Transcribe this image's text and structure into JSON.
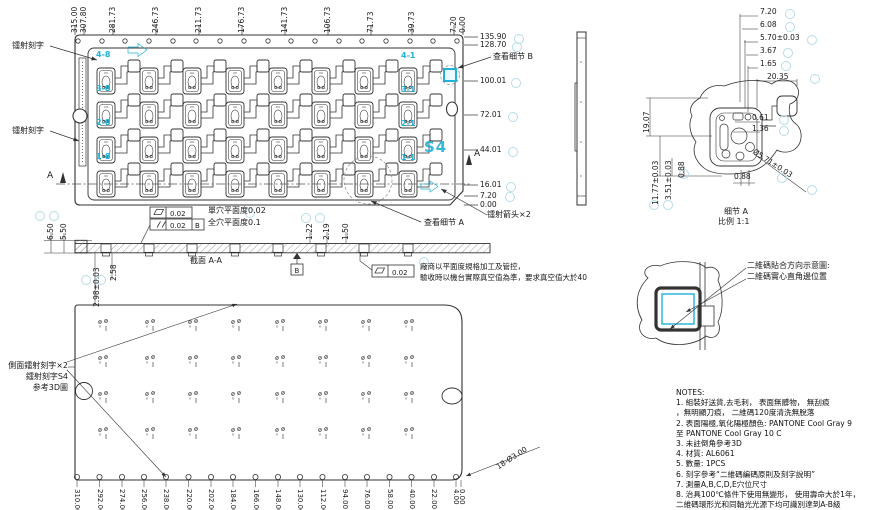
{
  "colors": {
    "cyan": "#1fb1d8",
    "line": "#333333",
    "balloon": "#b7dce8"
  },
  "top_view": {
    "laser_label_1": "镭射刻字",
    "laser_label_2": "镭射刻字",
    "top_dims": [
      "315.00",
      "307.80",
      "281.73",
      "246.73",
      "211.73",
      "176.73",
      "141.73",
      "106.73",
      "71.73",
      "39.73",
      "7.20",
      "0.00"
    ],
    "right_dims": [
      "135.90",
      "128.70",
      "100.01",
      "72.01",
      "44.01",
      "16.01",
      "7.20",
      "0.00"
    ],
    "row_labels_left": [
      "4-8",
      "3-8",
      "2-8",
      "1-8"
    ],
    "row_labels_right": [
      "4-1",
      "3-1",
      "2-1",
      "1-1"
    ],
    "marker_s4": "S4",
    "detail_b_note": "查看细节 B",
    "detail_a_note": "查看细节 A",
    "laser_arrow_note": "镭射箭头×2",
    "section_letter": "A"
  },
  "section": {
    "title": "截面 A-A",
    "dim_650": "6.50",
    "dim_550": "5.50",
    "dim_122": "1.22",
    "dim_219": "2.19",
    "dim_150": "1.50",
    "dim_298": "2.98±0.03",
    "dim_258": "2.58",
    "fcf_flat_val": "0.02",
    "fcf_par_val": "0.02",
    "fcf_par_datum": "B",
    "note_single": "單穴平面度0.02",
    "note_all": "全穴平面度0.1",
    "datum_b": "B",
    "fcf_right_val": "0.02",
    "vendor_note_1": "廠商以平面度規格加工及管控，",
    "vendor_note_2": "驗收時以機台實際真空值為準，要求真空值大於40"
  },
  "detail_a": {
    "dim_720": "7.20",
    "dim_608": "6.08",
    "dim_570": "5.70±0.03",
    "dim_367": "3.67",
    "dim_165": "1.65",
    "dim_2035": "20.35",
    "dim_1907": "19.07",
    "dim_1177": "11.77±0.03",
    "dim_351": "3.51±0.03",
    "dim_088_left": "0.88",
    "dim_061": "0.61",
    "dim_136": "1.36",
    "dim_dia": "Ø5.71±0.03",
    "dim_088_bottom": "0.88",
    "caption": "细节 A",
    "scale": "比例 1:1"
  },
  "qr_detail": {
    "line1": "二維碼貼合方向示意圖:",
    "line2": "二維碼實心直角邊位置"
  },
  "bottom_view": {
    "note_line1": "側面鐳射刻字×2",
    "note_line2": "鐳射刻字S4",
    "note_line3": "参考3D圖",
    "bottom_dims": [
      "310.00",
      "292.00",
      "274.00",
      "256.00",
      "238.00",
      "220.00",
      "202.00",
      "184.00",
      "166.00",
      "148.00",
      "130.00",
      "112.00",
      "94.00",
      "76.00",
      "58.00",
      "40.00",
      "22.00",
      "4.00",
      "0.00"
    ],
    "holes_label": "18-Ø3.00"
  },
  "notes": {
    "title": "NOTES:",
    "lines": [
      "1. 組裝好送貨,去毛刺， 表面無髒物， 無刮痕",
      "，無明顯刀痕， 二維碼120度清洗無脫落",
      "2. 表面陽極,氧化陽極顏色: PANTONE Cool Gray 9",
      "至 PANTONE Cool Gray 10 C",
      "3. 未註倒角參考3D",
      "4. 材質: AL6061",
      "5. 數量: 1PCS",
      "6. 刻字參考“二維碼編碼原則及刻字說明”",
      "7. 測量A,B,C,D,E穴位尺寸",
      "8. 治具100℃條件下使用無變形， 使用壽命大於1年，",
      "二維碼環形光和同軸光光源下均可識別達到A-B級"
    ]
  }
}
